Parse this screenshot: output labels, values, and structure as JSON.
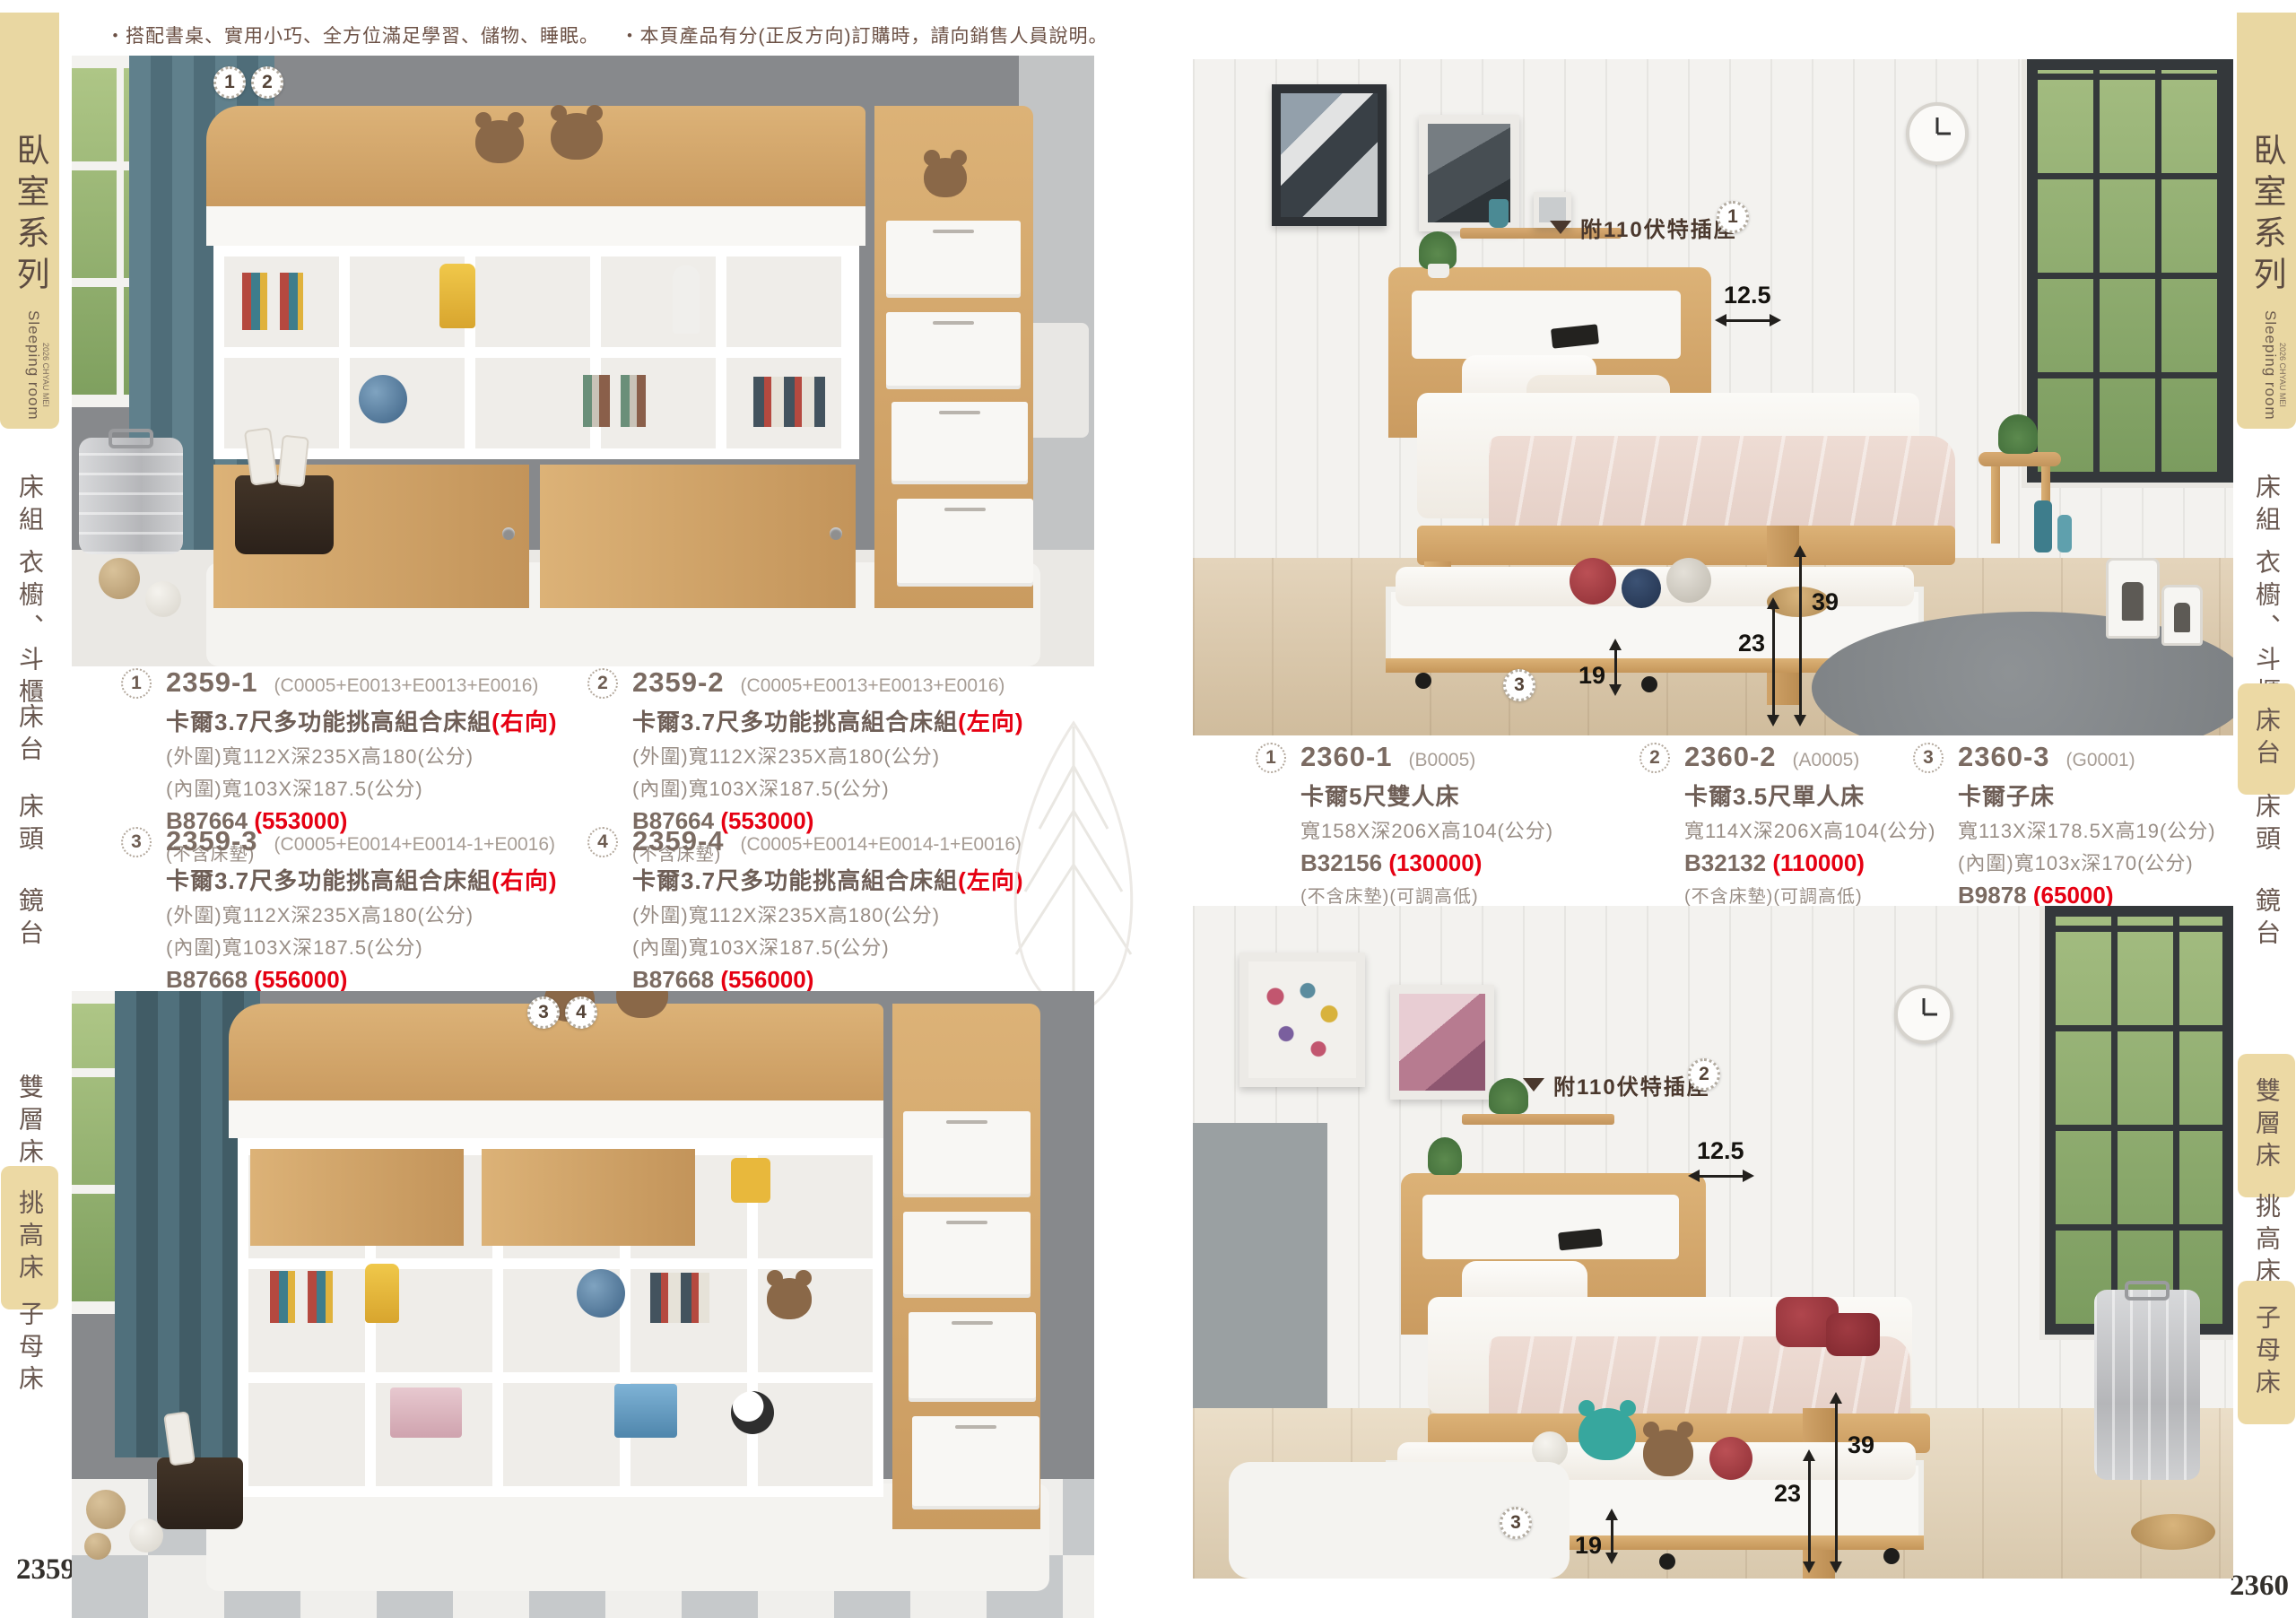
{
  "pages": {
    "left_number": "2359",
    "right_number": "2360"
  },
  "header_notes": {
    "note1": "・搭配書桌、實用小巧、全方位滿足學習、儲物、睡眠。",
    "note2": "・本頁產品有分(正反方向)訂購時，請向銷售人員說明。"
  },
  "sidebar": {
    "series_title": "臥室系列",
    "series_subtitle": "Sleeping room",
    "series_edition": "2026 CHYAU MEI",
    "items": [
      "床組",
      "衣櫥、斗櫃",
      "床台",
      "床頭",
      "鏡台",
      "雙層床",
      "挑高床",
      "子母床"
    ],
    "left_active_item": "挑高床",
    "right_active_items": [
      "床台",
      "雙層床",
      "子母床"
    ]
  },
  "products_left": [
    {
      "marker": "1",
      "model": "2359-1",
      "combo": "(C0005+E0013+E0013+E0016)",
      "name": "卡爾3.7尺多功能挑高組合床組",
      "direction": "(右向)",
      "spec1": "(外圍)寬112X深235X高180(公分)",
      "spec2": "(內圍)寬103X深187.5(公分)",
      "code": "B87664",
      "price": "(553000)",
      "note": "(不含床墊)"
    },
    {
      "marker": "2",
      "model": "2359-2",
      "combo": "(C0005+E0013+E0013+E0016)",
      "name": "卡爾3.7尺多功能挑高組合床組",
      "direction": "(左向)",
      "spec1": "(外圍)寬112X深235X高180(公分)",
      "spec2": "(內圍)寬103X深187.5(公分)",
      "code": "B87664",
      "price": "(553000)",
      "note": "(不含床墊)"
    },
    {
      "marker": "3",
      "model": "2359-3",
      "combo": "(C0005+E0014+E0014-1+E0016)",
      "name": "卡爾3.7尺多功能挑高組合床組",
      "direction": "(右向)",
      "spec1": "(外圍)寬112X深235X高180(公分)",
      "spec2": "(內圍)寬103X深187.5(公分)",
      "code": "B87668",
      "price": "(556000)",
      "note": "(不含床墊)"
    },
    {
      "marker": "4",
      "model": "2359-4",
      "combo": "(C0005+E0014+E0014-1+E0016)",
      "name": "卡爾3.7尺多功能挑高組合床組",
      "direction": "(左向)",
      "spec1": "(外圍)寬112X深235X高180(公分)",
      "spec2": "(內圍)寬103X深187.5(公分)",
      "code": "B87668",
      "price": "(556000)",
      "note": "(不含床墊)"
    }
  ],
  "products_right": [
    {
      "marker": "1",
      "model": "2360-1",
      "combo": "(B0005)",
      "name": "卡爾5尺雙人床",
      "spec1": "寬158X深206X高104(公分)",
      "code": "B32156",
      "price": "(130000)",
      "note1": "(不含床墊)(可調高低)",
      "note2": "(床板附四分正夾板)"
    },
    {
      "marker": "2",
      "model": "2360-2",
      "combo": "(A0005)",
      "name": "卡爾3.5尺單人床",
      "spec1": "寬114X深206X高104(公分)",
      "code": "B32132",
      "price": "(110000)",
      "note1": "(不含床墊)(可調高低)",
      "note2": "(床板附四分正夾板)"
    },
    {
      "marker": "3",
      "model": "2360-3",
      "combo": "(G0001)",
      "name": "卡爾子床",
      "spec1": "寬113X深178.5X高19(公分)",
      "spec2": "(內圍)寬103x深170(公分)",
      "code": "B9878",
      "price": "(65000)",
      "note1": "(不含床墊)(床板附四分正夾板)"
    }
  ],
  "photo_markers": {
    "left_top": [
      "1",
      "2"
    ],
    "left_bottom": [
      "3",
      "4"
    ],
    "right_top_main": "1",
    "right_top_trundle": "3",
    "right_bottom_main": "2",
    "right_bottom_trundle": "3"
  },
  "annotations": {
    "outlet_label": "附110伏特插座",
    "dim_shelf": "12.5",
    "dim_leg": "39",
    "dim_frame": "23",
    "dim_trundle": "19"
  },
  "colors": {
    "tab_beige": "#e9d7a2",
    "price_red": "#e60012",
    "wall_gray": "#87898c",
    "wood": "#d3a76b"
  }
}
